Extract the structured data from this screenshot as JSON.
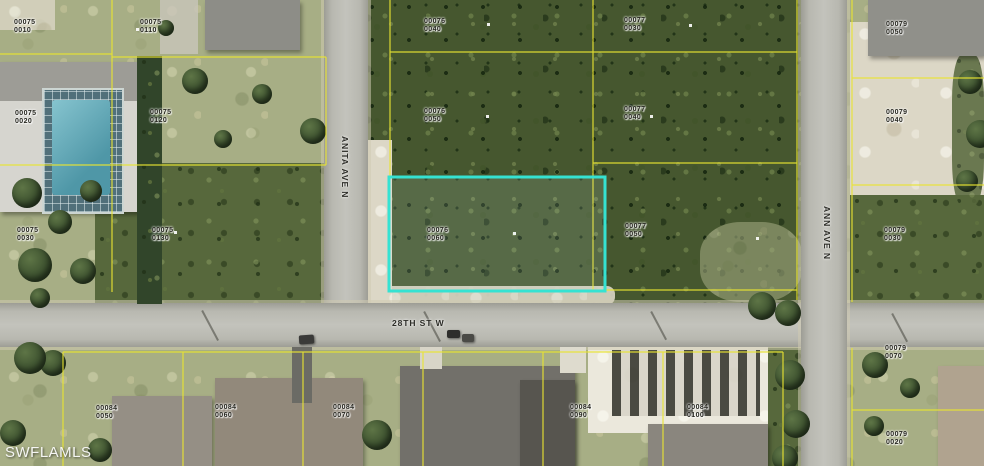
{
  "map": {
    "type": "aerial-parcel-map",
    "watermark": "SWFLAMLS",
    "parcel_line_color": "#e8e432",
    "highlighted_parcel": {
      "block": "00076",
      "lot": "0060",
      "outline_color": "#35e2d2"
    },
    "streets": [
      {
        "name": "ANITA AVE N",
        "orientation": "vertical",
        "x": 350,
        "y": 136
      },
      {
        "name": "28TH ST W",
        "orientation": "horizontal",
        "x": 392,
        "y": 318
      },
      {
        "name": "ANN AVE N",
        "orientation": "vertical",
        "x": 832,
        "y": 206
      }
    ],
    "parcel_labels": [
      {
        "lines": [
          "00075",
          "0010"
        ],
        "x": 14,
        "y": 19
      },
      {
        "lines": [
          "00075",
          "0110"
        ],
        "x": 140,
        "y": 19
      },
      {
        "lines": [
          "00076",
          "0040"
        ],
        "x": 424,
        "y": 18
      },
      {
        "lines": [
          "00077",
          "0030"
        ],
        "x": 624,
        "y": 17
      },
      {
        "lines": [
          "00079",
          "0050"
        ],
        "x": 886,
        "y": 21
      },
      {
        "lines": [
          "00075",
          "0020"
        ],
        "x": 15,
        "y": 110
      },
      {
        "lines": [
          "00075",
          "0120"
        ],
        "x": 150,
        "y": 109
      },
      {
        "lines": [
          "00076",
          "0050"
        ],
        "x": 424,
        "y": 108
      },
      {
        "lines": [
          "00077",
          "0040"
        ],
        "x": 624,
        "y": 106
      },
      {
        "lines": [
          "00079",
          "0040"
        ],
        "x": 886,
        "y": 109
      },
      {
        "lines": [
          "00075",
          "0030"
        ],
        "x": 17,
        "y": 227
      },
      {
        "lines": [
          "00075",
          "0130"
        ],
        "x": 152,
        "y": 227
      },
      {
        "lines": [
          "00076",
          "0060"
        ],
        "x": 427,
        "y": 227
      },
      {
        "lines": [
          "00077",
          "0050"
        ],
        "x": 625,
        "y": 223
      },
      {
        "lines": [
          "00079",
          "0030"
        ],
        "x": 884,
        "y": 227
      },
      {
        "lines": [
          "00079",
          "0070"
        ],
        "x": 885,
        "y": 345
      },
      {
        "lines": [
          "00079",
          "0020"
        ],
        "x": 886,
        "y": 431
      },
      {
        "lines": [
          "00084",
          "0050"
        ],
        "x": 96,
        "y": 405
      },
      {
        "lines": [
          "00084",
          "0060"
        ],
        "x": 215,
        "y": 404
      },
      {
        "lines": [
          "00084",
          "0070"
        ],
        "x": 333,
        "y": 404
      },
      {
        "lines": [
          "00084",
          "0090"
        ],
        "x": 570,
        "y": 404
      },
      {
        "lines": [
          "00084",
          "0100"
        ],
        "x": 687,
        "y": 404
      }
    ]
  }
}
